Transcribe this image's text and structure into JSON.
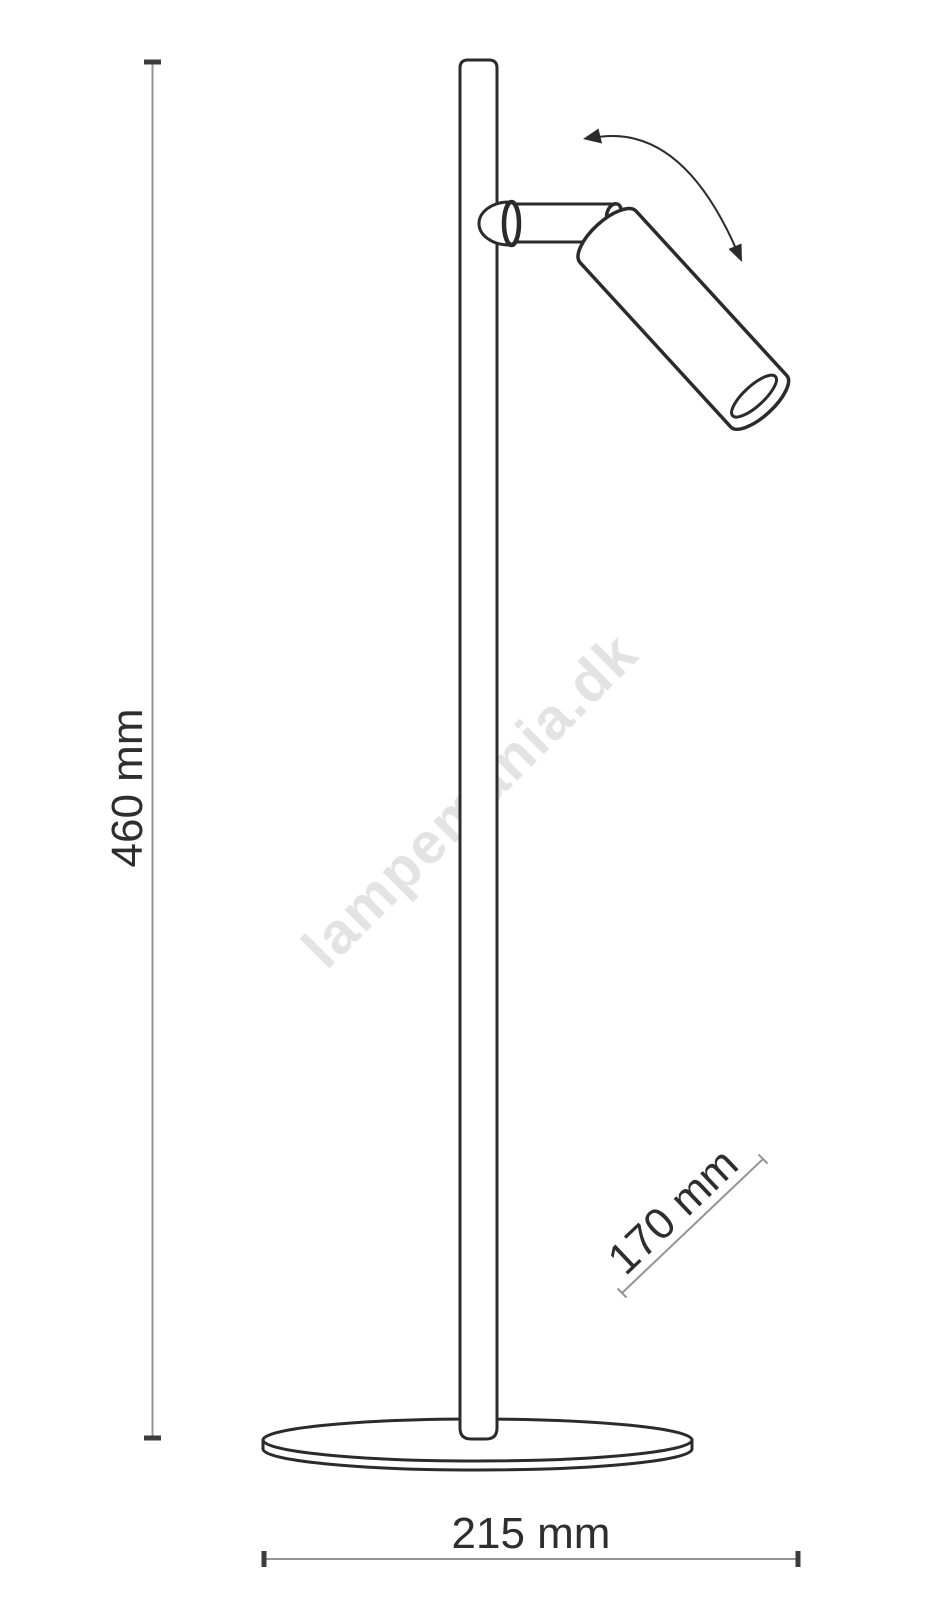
{
  "drawing": {
    "subject": "adjustable spotlight table lamp",
    "dimensions": {
      "height": {
        "label": "460 mm"
      },
      "head_length": {
        "label": "170 mm"
      },
      "base_width": {
        "label": "215 mm"
      }
    },
    "watermark": {
      "text": "lampemania.dk"
    },
    "icons": [
      {
        "name": "rotation-arrow-icon",
        "meaning": "head tilts / rotates"
      }
    ]
  },
  "colors": {
    "background": "#ffffff",
    "outline": "#2b2b2b",
    "dimension_line": "#949494",
    "dimension_tick": "#3c3c3c",
    "label_text": "#2e2e2e",
    "watermark": "#e3e3e3"
  }
}
